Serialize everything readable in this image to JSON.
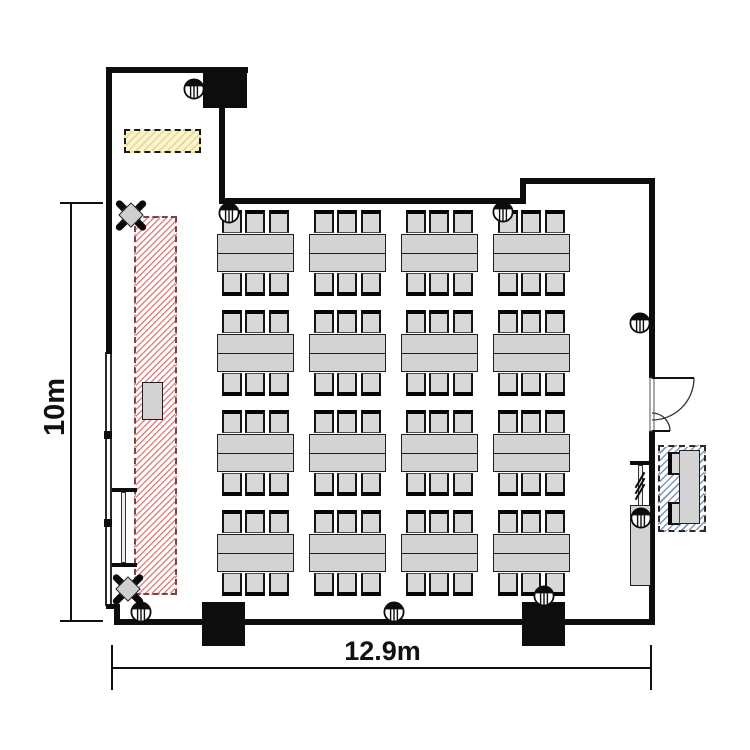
{
  "dimensions": {
    "height_label": "10m",
    "width_label": "12.9m"
  },
  "colors": {
    "wall": "#0d0d0d",
    "furniture_fill": "#d3d3d3",
    "furniture_border": "#1f1f1f",
    "stage_stripe": "#e08484",
    "stage_border": "#7a4545",
    "yellow_fill": "#faf4d0",
    "yellow_stripe": "#e7d694",
    "blue_stripe": "#7f97b8"
  },
  "seating": {
    "group_rows": 4,
    "group_cols": 4,
    "tables_per_group": 2,
    "chairs_per_side": 3,
    "total_chairs": 96,
    "row_y": [
      210,
      310,
      410,
      510
    ],
    "col_x": [
      217,
      309,
      401,
      493
    ],
    "group_width": 77,
    "table_height": 38,
    "chair_offsets": [
      5,
      28,
      52
    ]
  },
  "wall_symbols": [
    {
      "x": 194,
      "y": 89
    },
    {
      "x": 229,
      "y": 213
    },
    {
      "x": 503,
      "y": 212
    },
    {
      "x": 640,
      "y": 323
    },
    {
      "x": 641,
      "y": 518
    },
    {
      "x": 141,
      "y": 612
    },
    {
      "x": 394,
      "y": 612
    },
    {
      "x": 544,
      "y": 596
    }
  ],
  "spotlights": [
    {
      "x": 131,
      "y": 215
    },
    {
      "x": 128,
      "y": 589
    }
  ]
}
